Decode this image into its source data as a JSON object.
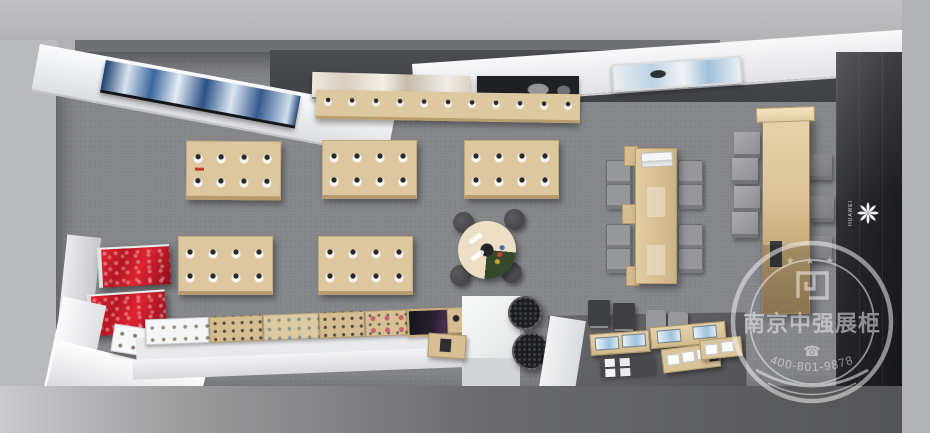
{
  "scene": {
    "description": "Top-down 3D rendering of a mobile phone brand showroom / exhibition store interior",
    "floor_color": "#84868a",
    "wood_color": "#dcc79f",
    "accent_red": "#c61826",
    "dark_wall_color": "#1d1f22",
    "counter_white": "#eceeef",
    "objects": [
      {
        "name": "wall-display-screens",
        "count": 4
      },
      {
        "name": "wall-product-bar",
        "count": 1
      },
      {
        "name": "product-display-table",
        "count": 5
      },
      {
        "name": "round-demo-table",
        "stools": 4
      },
      {
        "name": "conference-table",
        "chairs": 8
      },
      {
        "name": "tall-display-cabinet",
        "count": 1
      },
      {
        "name": "wall-mounted-display-box",
        "count": 7
      },
      {
        "name": "red-lightbox-display",
        "count": 2
      },
      {
        "name": "accessory-counter-trays",
        "count": 7
      },
      {
        "name": "experience-counters-with-screens",
        "count": 2
      },
      {
        "name": "potted-plant",
        "count": 2
      },
      {
        "name": "white-pedestal",
        "count": 1
      }
    ]
  },
  "brand": {
    "logo_icon": "huawei-flower-logo",
    "logo_text": "HUAWEI"
  },
  "watermark": {
    "stars": "★ ★ ★",
    "company_name": "南京中强展柜",
    "phone_icon": "☎",
    "phone_number": "400-801-9878",
    "color": "#f5f5f5"
  }
}
